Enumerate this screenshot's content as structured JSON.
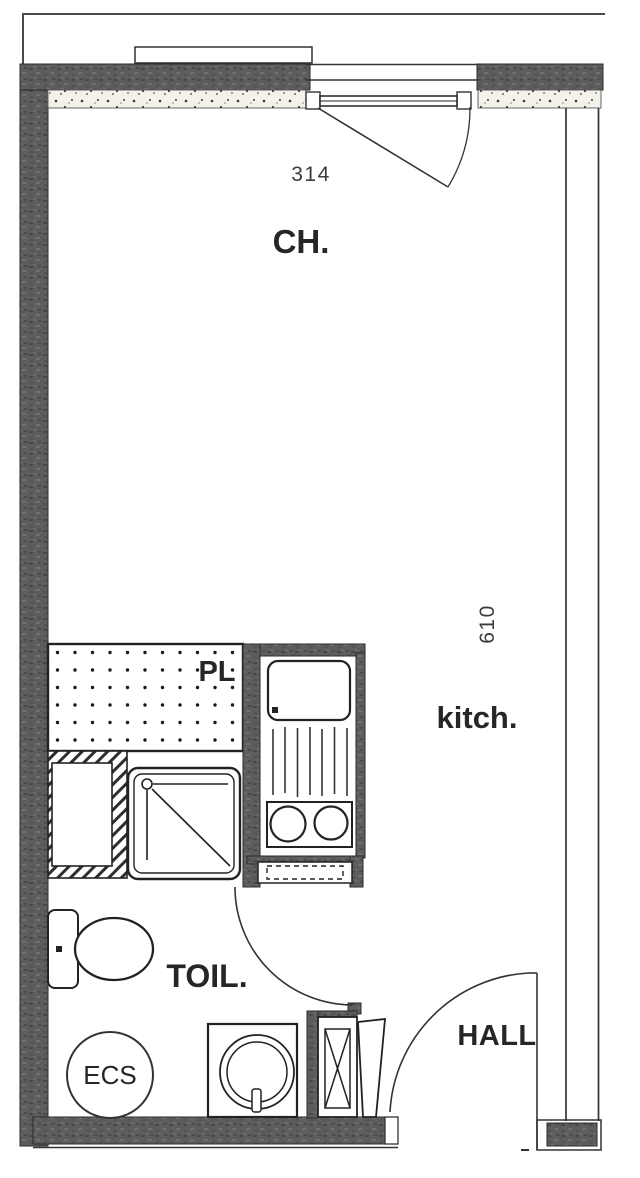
{
  "plan": {
    "type": "studio-apartment-floor-plan",
    "labels": {
      "room_ch": "CH.",
      "room_kitch": "kitch.",
      "closet": "PL",
      "toilet_room": "TOIL.",
      "hall": "HALL",
      "water_heater": "ECS"
    },
    "dimensions": {
      "top_width": "314",
      "right_height": "610"
    },
    "fixtures": [
      "french-window-with-swing",
      "closet-dotted-area",
      "hatched-duct-unit",
      "shower-tray",
      "kitchen-sink",
      "drainboard",
      "hob-two-burners",
      "dashed-plinth",
      "toilet-wc",
      "water-heater-cylinder",
      "washbasin",
      "technical-shaft-x",
      "entry-door-leaf",
      "bathroom-door-arc",
      "entry-door-arc"
    ],
    "colors": {
      "wall": "#5d5d5d",
      "wall_fleck_dark": "#484848",
      "wall_fleck_light": "#707070",
      "line": "#222222",
      "label": "#262626",
      "dim_text": "#3c3c3c",
      "paper": "#ffffff",
      "insulation_bg": "#f3f1ea"
    }
  }
}
